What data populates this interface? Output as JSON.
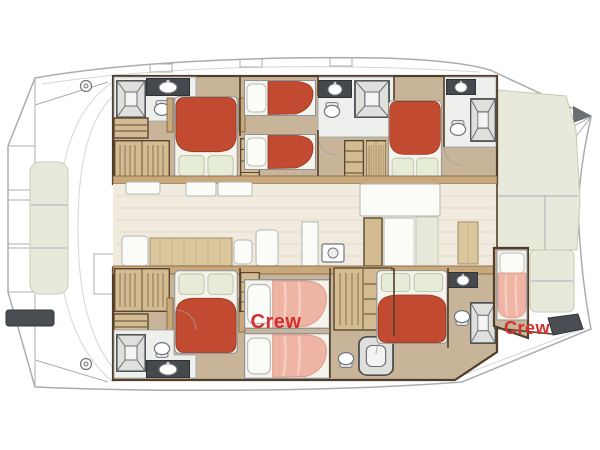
{
  "diagram": {
    "kind": "catamaran-deck-floor-plan",
    "labels": {
      "crew_mid": "Crew",
      "crew_forepeak": "Crew"
    },
    "colors": {
      "bed-red": "#c14a30",
      "bed-red-edge": "#93371f",
      "crew-bed": "#eeb4a4",
      "crew-bed-edge": "#dd9d8d",
      "crew-text": "#d4302f",
      "floor-tan": "#c8b499",
      "wood": "#c9a87c",
      "wood-light": "#dbc79e",
      "trim-dark": "#503e2a",
      "salon-floor": "#f1ebdf",
      "salon-line": "#e2d9c5",
      "cushion-green": "#e7eada",
      "cushion-edge": "#c6cbb2",
      "pillow-green": "#e7ecd8",
      "hull-line": "#a9adb1",
      "fixture": "#6f747a",
      "counter-dark": "#45494d",
      "bath-floor": "#eef0ee"
    }
  }
}
